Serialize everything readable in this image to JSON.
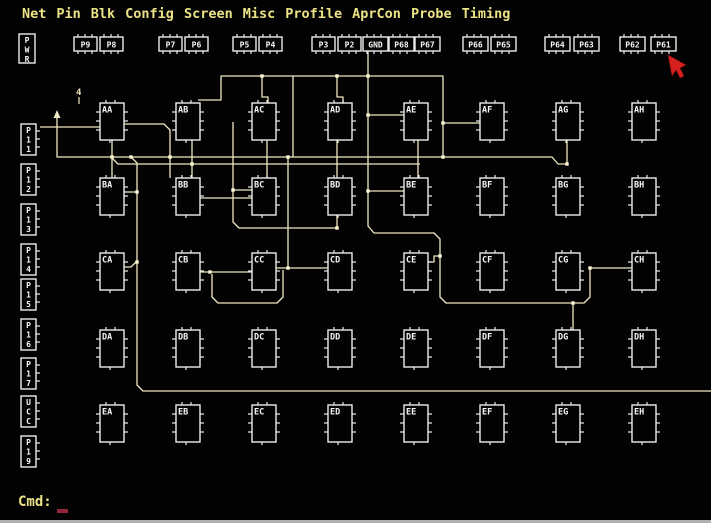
{
  "colors": {
    "background": "#020202",
    "wire": "#efe8c2",
    "junction": "#fcf6d2",
    "outline": "#ededed",
    "label": "#f6f6f6",
    "menu_text": "#ece387",
    "cmd_text": "#ece387",
    "cmd_cursor": "#93243c",
    "mouse_red": "#d62020"
  },
  "menu": {
    "items": [
      "Net",
      "Pin",
      "Blk",
      "Config",
      "Screen",
      "Misc",
      "Profile",
      "AprCon",
      "Probe",
      "Timing"
    ]
  },
  "command": {
    "label": "Cmd:",
    "cursor": "_"
  },
  "top_pins": {
    "y": 37,
    "w": 23,
    "h": 14,
    "items": [
      {
        "label": "P9",
        "x": 74
      },
      {
        "label": "P8",
        "x": 100
      },
      {
        "label": "P7",
        "x": 159
      },
      {
        "label": "P6",
        "x": 185
      },
      {
        "label": "P5",
        "x": 233
      },
      {
        "label": "P4",
        "x": 259
      },
      {
        "label": "P3",
        "x": 312
      },
      {
        "label": "P2",
        "x": 338
      },
      {
        "label": "GND",
        "x": 363
      },
      {
        "label": "P68",
        "x": 389
      },
      {
        "label": "P67",
        "x": 415
      },
      {
        "label": "P66",
        "x": 463
      },
      {
        "label": "P65",
        "x": 491
      },
      {
        "label": "P64",
        "x": 545
      },
      {
        "label": "P63",
        "x": 574
      },
      {
        "label": "P62",
        "x": 620
      },
      {
        "label": "P61",
        "x": 651
      }
    ]
  },
  "left_pins": {
    "x": 21,
    "w": 15,
    "h": 31,
    "items": [
      {
        "label": "PWR",
        "chars": [
          "P",
          "W",
          "R"
        ],
        "x": 19,
        "y": 34,
        "w": 16,
        "h": 29,
        "ticks": false
      },
      {
        "label": "P11",
        "chars": [
          "P",
          "1",
          "1"
        ],
        "y": 124,
        "ticks": true
      },
      {
        "label": "P12",
        "chars": [
          "P",
          "1",
          "2"
        ],
        "y": 164,
        "ticks": true
      },
      {
        "label": "P13",
        "chars": [
          "P",
          "1",
          "3"
        ],
        "y": 204,
        "ticks": true
      },
      {
        "label": "P14",
        "chars": [
          "P",
          "1",
          "4"
        ],
        "y": 244,
        "ticks": true
      },
      {
        "label": "P15",
        "chars": [
          "P",
          "1",
          "5"
        ],
        "y": 279,
        "ticks": true
      },
      {
        "label": "P16",
        "chars": [
          "P",
          "1",
          "6"
        ],
        "y": 319,
        "ticks": true
      },
      {
        "label": "P17",
        "chars": [
          "P",
          "1",
          "7"
        ],
        "y": 358,
        "ticks": true
      },
      {
        "label": "UCC",
        "chars": [
          "U",
          "C",
          "C"
        ],
        "y": 396,
        "ticks": true
      },
      {
        "label": "P19",
        "chars": [
          "P",
          "1",
          "9"
        ],
        "y": 436,
        "ticks": true
      }
    ]
  },
  "blocks": {
    "w": 24,
    "h": 37,
    "col_x": [
      100,
      176,
      252,
      328,
      404,
      480,
      556,
      632
    ],
    "row_y": [
      103,
      178,
      253,
      330,
      405
    ],
    "labels": [
      [
        "AA",
        "AB",
        "AC",
        "AD",
        "AE",
        "AF",
        "AG",
        "AH"
      ],
      [
        "BA",
        "BB",
        "BC",
        "BD",
        "BE",
        "BF",
        "BG",
        "BH"
      ],
      [
        "CA",
        "CB",
        "CC",
        "CD",
        "CE",
        "CF",
        "CG",
        "CH"
      ],
      [
        "DA",
        "DB",
        "DC",
        "DD",
        "DE",
        "DF",
        "DG",
        "DH"
      ],
      [
        "EA",
        "EB",
        "EC",
        "ED",
        "EE",
        "EF",
        "EG",
        "EH"
      ]
    ]
  },
  "wires": [
    {
      "points": [
        [
          198,
          100
        ],
        [
          221,
          100
        ],
        [
          221,
          76
        ],
        [
          443,
          76
        ],
        [
          443,
          123
        ],
        [
          480,
          123
        ]
      ]
    },
    {
      "points": [
        [
          262,
          76
        ],
        [
          262,
          97
        ],
        [
          268,
          97
        ],
        [
          268,
          104
        ]
      ]
    },
    {
      "points": [
        [
          337,
          76
        ],
        [
          337,
          97
        ],
        [
          343,
          97
        ],
        [
          343,
          104
        ]
      ]
    },
    {
      "points": [
        [
          368,
          50
        ],
        [
          368,
          226
        ],
        [
          374,
          233
        ],
        [
          434,
          233
        ],
        [
          440,
          239
        ],
        [
          440,
          297
        ],
        [
          446,
          303
        ],
        [
          584,
          303
        ],
        [
          590,
          297
        ],
        [
          590,
          268
        ]
      ]
    },
    {
      "points": [
        [
          368,
          115
        ],
        [
          404,
          115
        ]
      ]
    },
    {
      "points": [
        [
          368,
          191
        ],
        [
          404,
          191
        ]
      ]
    },
    {
      "points": [
        [
          428,
          262
        ],
        [
          434,
          262
        ],
        [
          434,
          256
        ],
        [
          440,
          256
        ]
      ]
    },
    {
      "points": [
        [
          573,
          303
        ],
        [
          573,
          330
        ]
      ]
    },
    {
      "points": [
        [
          590,
          268
        ],
        [
          632,
          268
        ]
      ]
    },
    {
      "points": [
        [
          57,
          115
        ],
        [
          57,
          157
        ],
        [
          552,
          157
        ],
        [
          558,
          164
        ],
        [
          567,
          164
        ]
      ]
    },
    {
      "points": [
        [
          567,
          140
        ],
        [
          567,
          164
        ]
      ]
    },
    {
      "points": [
        [
          443,
          123
        ],
        [
          443,
          157
        ]
      ]
    },
    {
      "points": [
        [
          293,
          76
        ],
        [
          293,
          157
        ]
      ]
    },
    {
      "points": [
        [
          111,
          157
        ],
        [
          118,
          164
        ],
        [
          420,
          164
        ]
      ]
    },
    {
      "points": [
        [
          112,
          140
        ],
        [
          112,
          178
        ]
      ]
    },
    {
      "points": [
        [
          124,
          124
        ],
        [
          164,
          124
        ],
        [
          170,
          130
        ],
        [
          170,
          178
        ]
      ]
    },
    {
      "points": [
        [
          192,
          140
        ],
        [
          192,
          178
        ]
      ]
    },
    {
      "points": [
        [
          40,
          127
        ],
        [
          100,
          127
        ]
      ]
    },
    {
      "points": [
        [
          131,
          157
        ],
        [
          137,
          163
        ],
        [
          137,
          385
        ],
        [
          143,
          391
        ],
        [
          711,
          391
        ]
      ]
    },
    {
      "points": [
        [
          124,
          192
        ],
        [
          137,
          192
        ]
      ]
    },
    {
      "points": [
        [
          124,
          267
        ],
        [
          131,
          267
        ],
        [
          137,
          261
        ]
      ]
    },
    {
      "points": [
        [
          233,
          122
        ],
        [
          233,
          222
        ],
        [
          239,
          228
        ],
        [
          337,
          228
        ]
      ]
    },
    {
      "points": [
        [
          337,
          215
        ],
        [
          337,
          228
        ]
      ]
    },
    {
      "points": [
        [
          337,
          140
        ],
        [
          337,
          178
        ]
      ]
    },
    {
      "points": [
        [
          418,
          140
        ],
        [
          418,
          178
        ]
      ]
    },
    {
      "points": [
        [
          233,
          190
        ],
        [
          252,
          190
        ]
      ]
    },
    {
      "points": [
        [
          200,
          198
        ],
        [
          252,
          198
        ]
      ]
    },
    {
      "points": [
        [
          200,
          272
        ],
        [
          252,
          272
        ]
      ]
    },
    {
      "points": [
        [
          276,
          268
        ],
        [
          328,
          268
        ]
      ]
    },
    {
      "points": [
        [
          288,
          157
        ],
        [
          288,
          268
        ]
      ]
    },
    {
      "points": [
        [
          212,
          274
        ],
        [
          212,
          297
        ],
        [
          218,
          303
        ],
        [
          277,
          303
        ],
        [
          283,
          297
        ],
        [
          283,
          270
        ]
      ]
    },
    {
      "points": [
        [
          267,
          140
        ],
        [
          267,
          178
        ]
      ]
    }
  ],
  "junctions": [
    [
      262,
      76
    ],
    [
      337,
      76
    ],
    [
      368,
      76
    ],
    [
      443,
      123
    ],
    [
      443,
      157
    ],
    [
      368,
      115
    ],
    [
      368,
      191
    ],
    [
      590,
      268
    ],
    [
      573,
      303
    ],
    [
      567,
      164
    ],
    [
      337,
      228
    ],
    [
      288,
      268
    ],
    [
      210,
      272
    ],
    [
      137,
      192
    ],
    [
      112,
      157
    ],
    [
      170,
      157
    ],
    [
      192,
      164
    ],
    [
      233,
      190
    ],
    [
      288,
      157
    ],
    [
      440,
      256
    ],
    [
      131,
      157
    ],
    [
      137,
      262
    ]
  ],
  "arrow_terminal": {
    "points": "57,110 53.5,118 60.5,118"
  },
  "marker4": {
    "text": "4",
    "x": 76,
    "y": 95,
    "tail": [
      [
        79,
        97
      ],
      [
        79,
        104
      ]
    ]
  },
  "mouse_cursor": {
    "points": "668,55 672,76 676,70 680,78 684,76 680,68 686,65"
  }
}
